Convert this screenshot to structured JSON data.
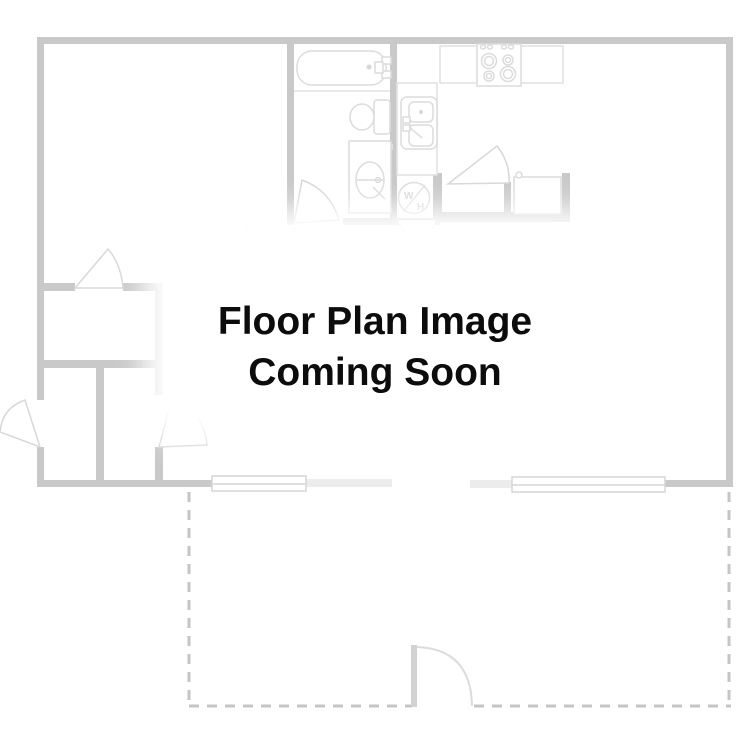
{
  "placeholder": {
    "line1": "Floor Plan Image",
    "line2": "Coming Soon"
  },
  "fixtures": {
    "water_heater_letter_top": "W",
    "water_heater_letter_bottom": "H"
  },
  "colors": {
    "background": "#ffffff",
    "wall": "#c9c9c9",
    "wall_light": "#ececec",
    "fixture_outline": "#dcdcdc",
    "faint_outline": "#e4e4e4",
    "patio_dash": "#c5c5c5",
    "text": "#0c0c0c"
  }
}
